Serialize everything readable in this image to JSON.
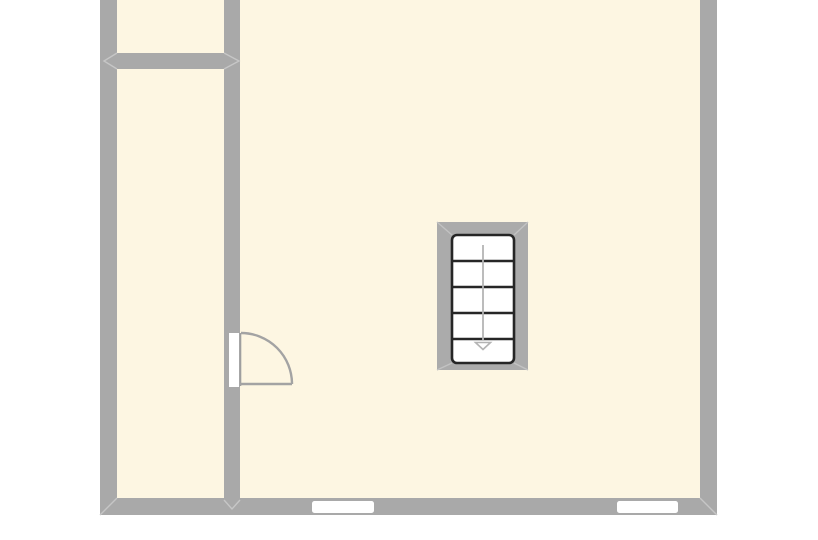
{
  "canvas": {
    "background": "#ffffff",
    "width": 818,
    "height": 540
  },
  "palette": {
    "room_fill": "#fdf6e2",
    "wall": "#a9a9a9",
    "wall_seam": "#c6c6c6",
    "stair_frame": "#ababab",
    "stair_frame_seam": "#c2c2c2",
    "stair_fill": "#ffffff",
    "stair_outline": "#262626",
    "stair_direction": "#b4b4b4",
    "door_symbol": "#a3a3a3",
    "door_jamb": "#9f9f9f",
    "door_opening": "#ffffff",
    "window_fill": "#ffffff"
  },
  "floorplan": {
    "structure": {
      "walls": [
        "left-exterior",
        "right-exterior",
        "bottom-exterior",
        "vertical-divider",
        "top-left-partition"
      ],
      "rooms_visible": 3,
      "plan_cut_off_at_top": true
    },
    "symbols": {
      "staircase": {
        "treads": 5,
        "direction_arrow": "down"
      },
      "door": {
        "type": "single-leaf-swing",
        "wall": "vertical-divider",
        "swing": "quarter-circle-into-main-room"
      },
      "windows": [
        {
          "wall": "bottom",
          "position": "left-of-center"
        },
        {
          "wall": "bottom",
          "position": "right"
        }
      ]
    }
  }
}
